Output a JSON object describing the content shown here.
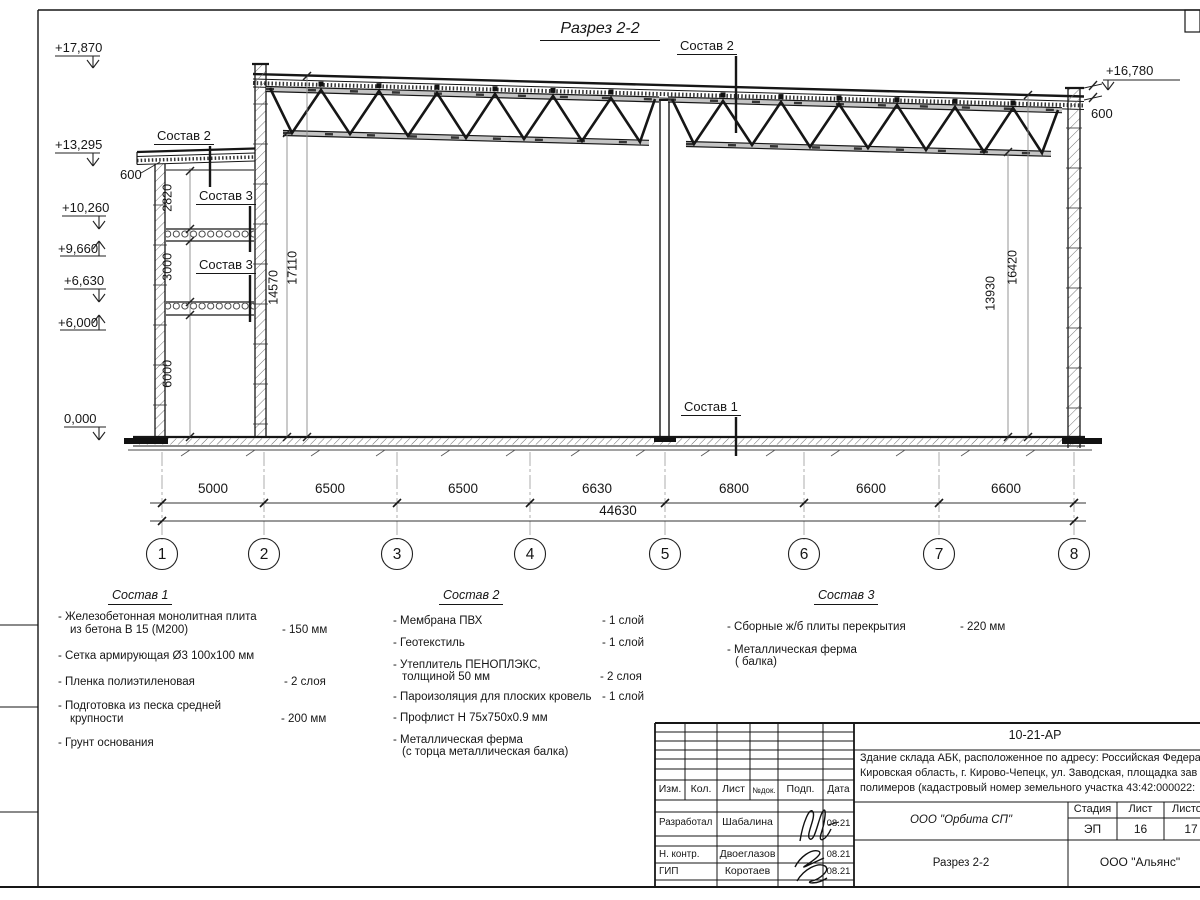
{
  "sheet": {
    "title": "Разрез 2-2"
  },
  "elevations": {
    "e17870": "+17,870",
    "e13295": "+13,295",
    "e10260": "+10,260",
    "e9660": "+9,660",
    "e6630": "+6,630",
    "e6000": "+6,000",
    "e0": "0,000",
    "e16780": "+16,780"
  },
  "dims": {
    "parapet_left": "600",
    "parapet_right": "600",
    "annex": [
      "2820",
      "3000",
      "6000"
    ],
    "hall": [
      "14570",
      "17110",
      "13930",
      "16420"
    ],
    "axis": [
      "5000",
      "6500",
      "6500",
      "6630",
      "6800",
      "6600",
      "6600"
    ],
    "total": "44630"
  },
  "axes": [
    "1",
    "2",
    "3",
    "4",
    "5",
    "6",
    "7",
    "8"
  ],
  "callouts": {
    "c1": "Состав 1",
    "c2": "Состав 2",
    "c3": "Состав 3"
  },
  "notes": {
    "s1": {
      "title": "Состав 1",
      "i1a": "- Железобетонная  монолитная плита",
      "i1b": "из бетона В 15 (М200)",
      "i1v": "- 150 мм",
      "i2": "- Сетка армирующая Ø3 100х100 мм",
      "i3": "- Пленка полиэтиленовая",
      "i3v": "-  2 слоя",
      "i4a": "- Подготовка из песка средней",
      "i4b": "крупности",
      "i4v": "- 200 мм",
      "i5": "- Грунт основания"
    },
    "s2": {
      "title": "Состав 2",
      "i1": "- Мембрана ПВХ",
      "i1v": "- 1 слой",
      "i2": "- Геотекстиль",
      "i2v": "- 1 слой",
      "i3a": "- Утеплитель ПЕНОПЛЭКС,",
      "i3b": "толщиной 50 мм",
      "i3v": "- 2 слоя",
      "i4": "- Пароизоляция для плоских кровель",
      "i4v": "- 1 слой",
      "i5": "- Профлист Н 75х750х0.9 мм",
      "i6a": "- Металлическая ферма",
      "i6b": "(с торца металлическая балка)"
    },
    "s3": {
      "title": "Состав 3",
      "i1": "- Сборные ж/б плиты перекрытия",
      "i1v": "- 220 мм",
      "i2a": "- Металлическая ферма",
      "i2b": "( балка)"
    }
  },
  "titleblock": {
    "code": "10-21-АР",
    "desc1": "Здание склада АБК, расположенное по адресу: Российская Федера",
    "desc2": "Кировская область, г. Кирово-Чепецк, ул. Заводская, площадка зав",
    "desc3": "полимеров (кадастровый номер земельного участка 43:42:000022:",
    "cols": {
      "izm": "Изм.",
      "kol": "Кол.",
      "list": "Лист",
      "ndok": "№док.",
      "podp": "Подп.",
      "data": "Дата"
    },
    "rows": [
      {
        "role": "Разработал",
        "name": "Шабалина",
        "date": "08.21"
      },
      {
        "role": "Н. контр.",
        "name": "Двоеглазов",
        "date": "08.21"
      },
      {
        "role": "ГИП",
        "name": "Коротаев",
        "date": "08.21"
      }
    ],
    "org": "ООО \"Орбита СП\"",
    "stage_label": "Стадия",
    "list_label": "Лист",
    "listov_label": "Листов",
    "stage": "ЭП",
    "list_no": "16",
    "listov": "17",
    "doc_title": "Разрез 2-2",
    "company": "ООО \"Альянс\""
  }
}
